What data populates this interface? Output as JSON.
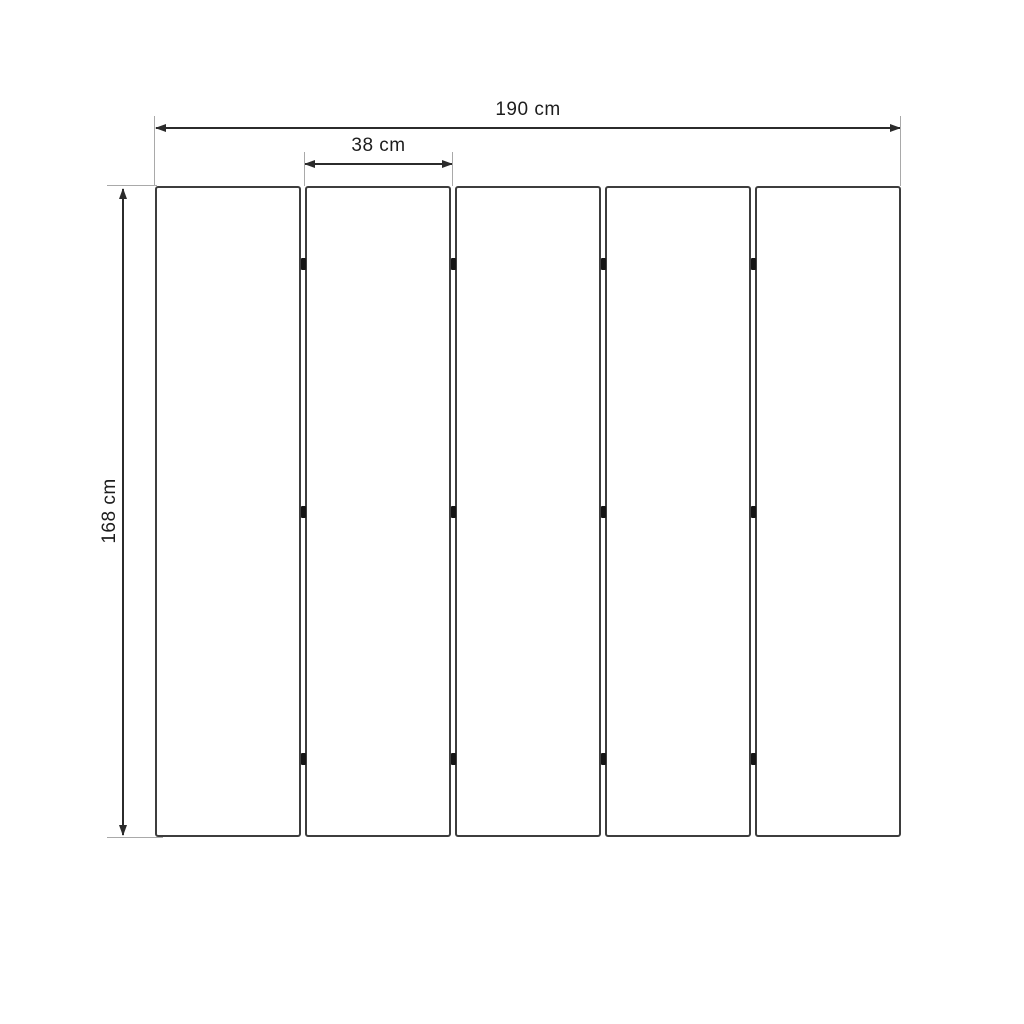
{
  "diagram": {
    "labels": {
      "total_width": "190 cm",
      "panel_width": "38 cm",
      "height": "168 cm"
    },
    "panels": {
      "count": 5,
      "joints": 4,
      "hinges_per_joint": 3,
      "hinge_row_offsets_pct": [
        12,
        50,
        88
      ]
    },
    "colors": {
      "background": "#ffffff",
      "panel_border": "#3d3d3d",
      "dimension": "#2b2b2b",
      "extension_line": "#a9a9a9",
      "hinge": "#141414",
      "label_text": "#1d1d1d"
    }
  }
}
